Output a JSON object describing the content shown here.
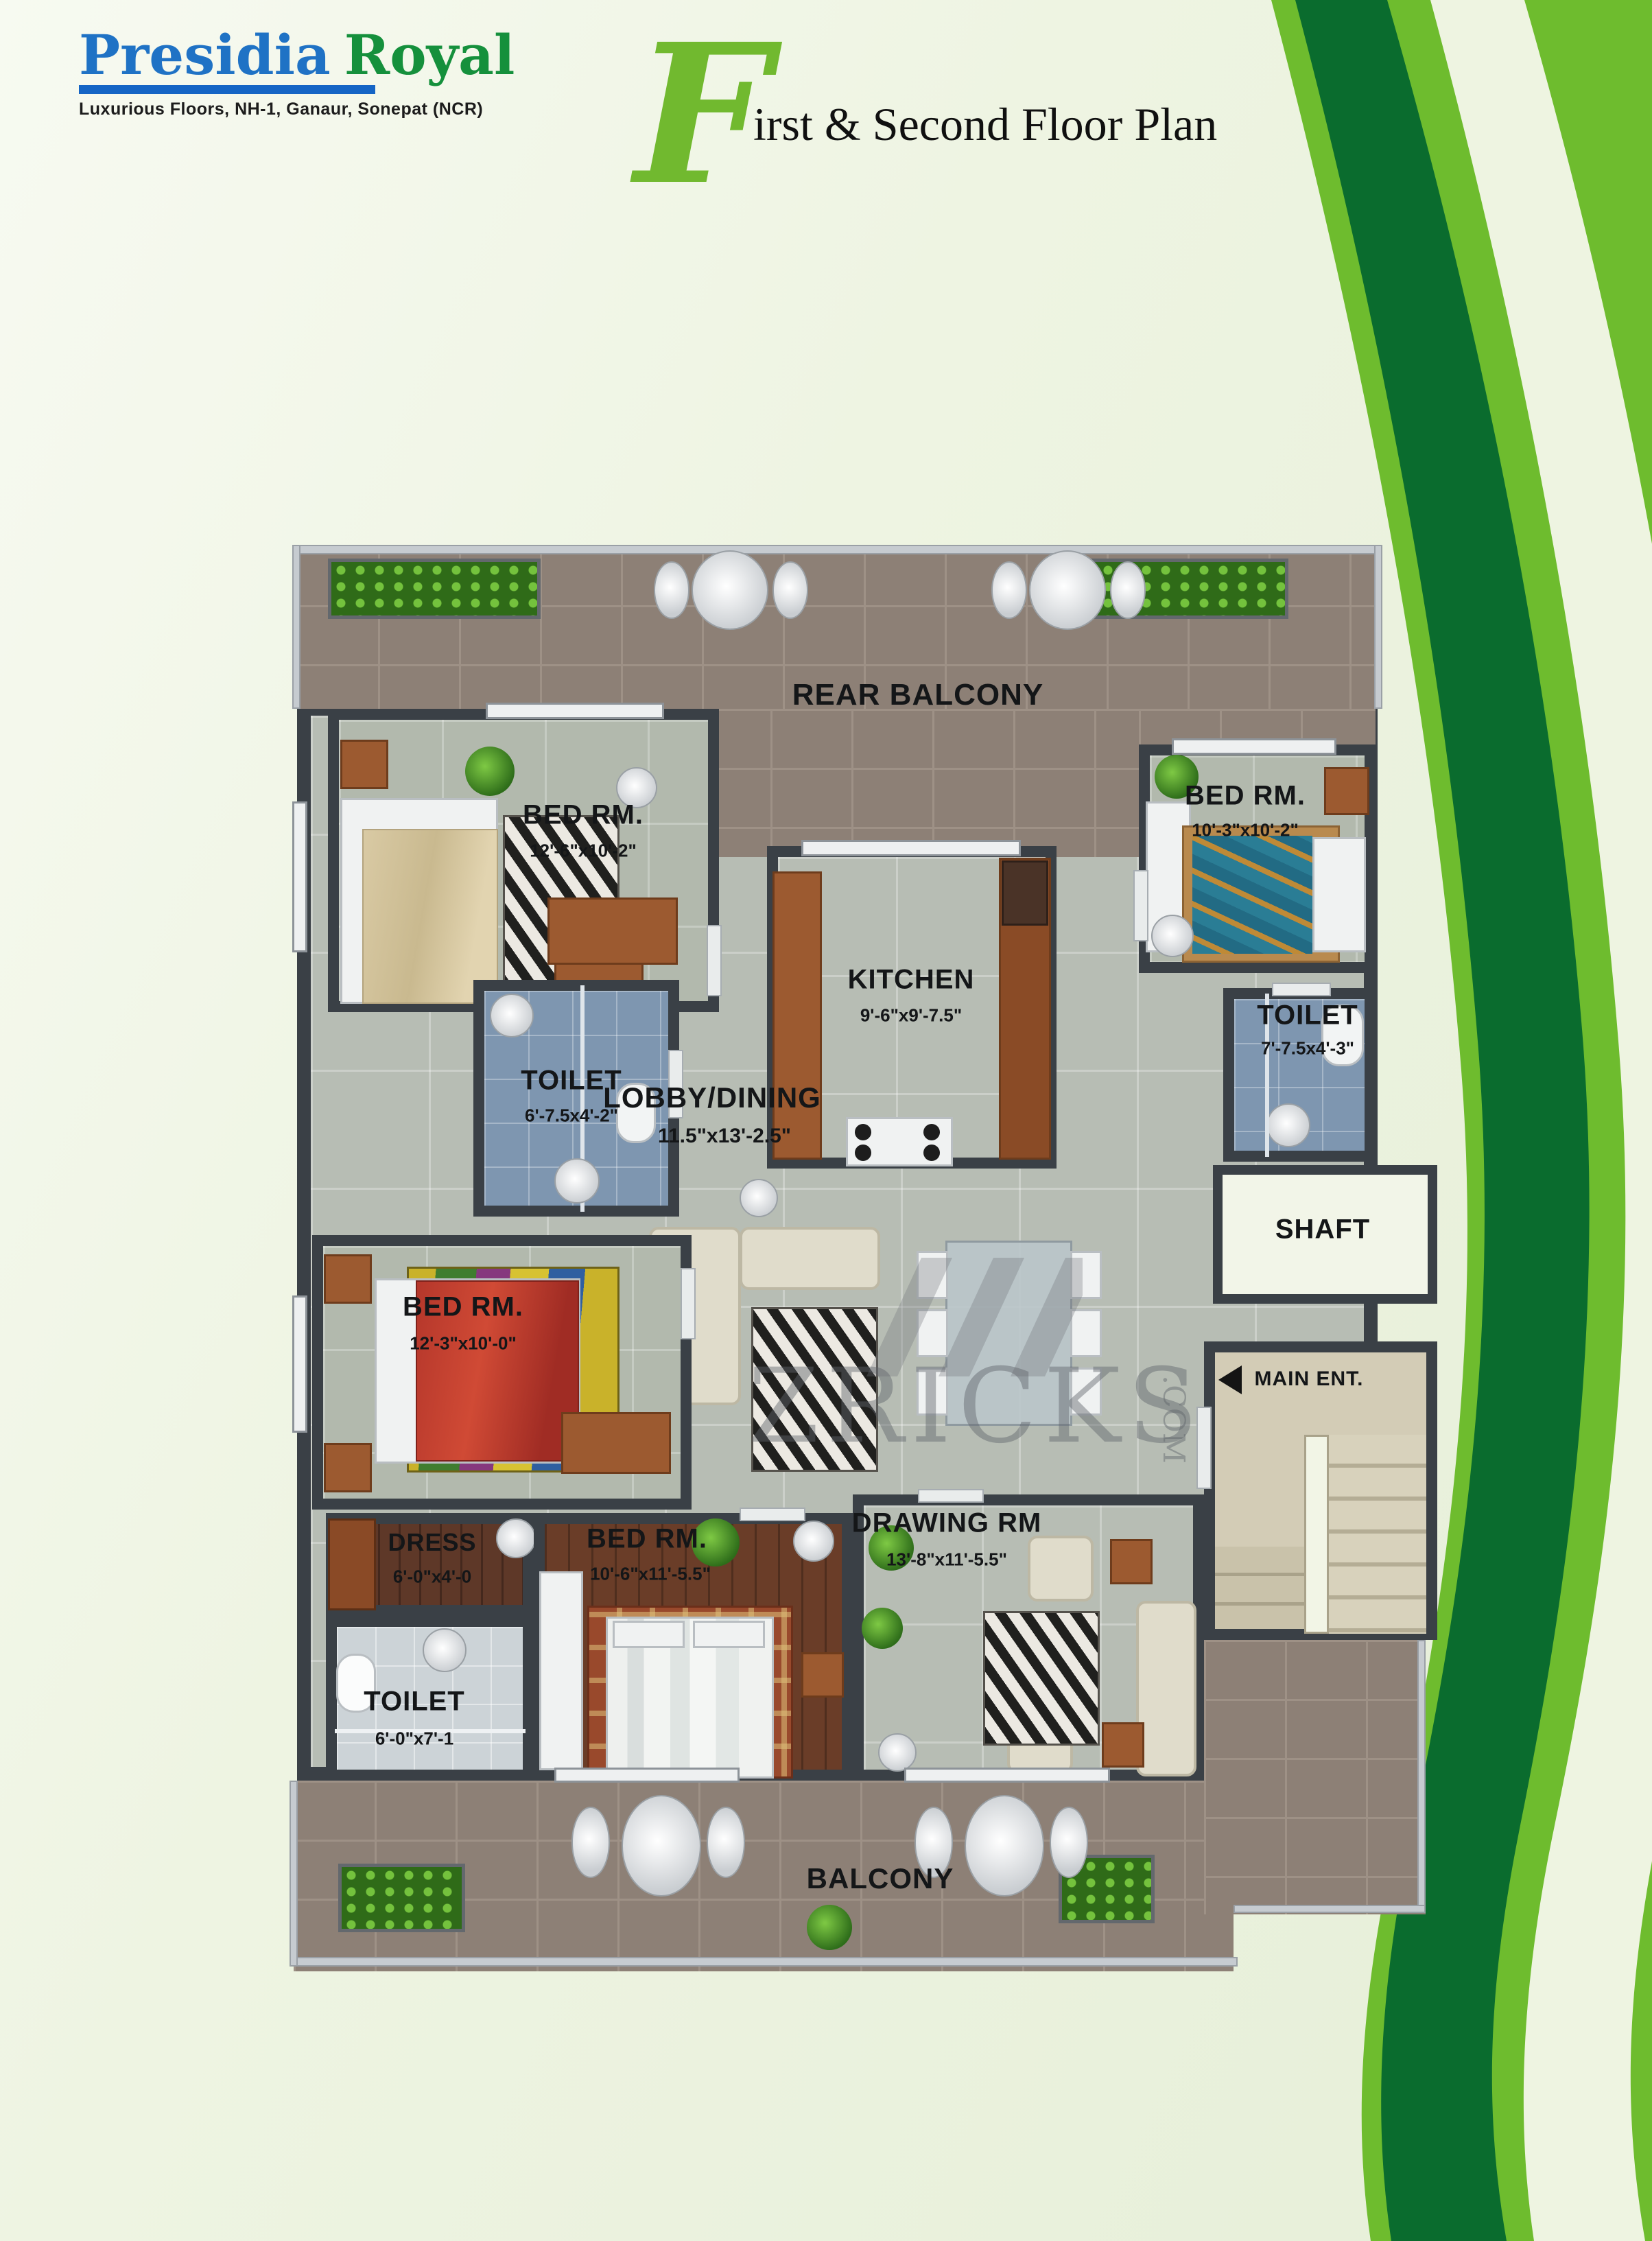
{
  "header": {
    "logo": {
      "name_primary": "Presidia",
      "name_secondary": "Royal",
      "subtitle": "Luxurious Floors, NH-1, Ganaur, Sonepat (NCR)"
    },
    "title": {
      "initial": "F",
      "rest": "irst & Second Floor Plan"
    }
  },
  "watermark": {
    "text": "ZRICKS",
    "suffix": ".COM"
  },
  "colors": {
    "accent_green": "#6ebc2e",
    "dark_green": "#0a6c2e",
    "pale_band": "#eef4e1",
    "logo_blue": "#1f72c5",
    "logo_green": "#15903c",
    "wall": "#3a4046"
  },
  "floor_plan": {
    "rooms": [
      {
        "id": "rear-balcony",
        "label": "REAR BALCONY",
        "dims": ""
      },
      {
        "id": "bed-room-1",
        "label": "BED RM.",
        "dims": "12'-6\"x10'-2\""
      },
      {
        "id": "kitchen",
        "label": "KITCHEN",
        "dims": "9'-6\"x9'-7.5\""
      },
      {
        "id": "bed-room-2",
        "label": "BED RM.",
        "dims": "10'-3\"x10'-2\""
      },
      {
        "id": "toilet-1",
        "label": "TOILET",
        "dims": "6'-7.5x4'-2\""
      },
      {
        "id": "toilet-2",
        "label": "TOILET",
        "dims": "7'-7.5x4'-3\""
      },
      {
        "id": "lobby-dining",
        "label": "LOBBY/DINING",
        "dims": "11.5\"x13'-2.5\""
      },
      {
        "id": "shaft",
        "label": "SHAFT",
        "dims": ""
      },
      {
        "id": "bed-room-3",
        "label": "BED RM.",
        "dims": "12'-3\"x10'-0\""
      },
      {
        "id": "dress",
        "label": "DRESS",
        "dims": "6'-0\"x4'-0"
      },
      {
        "id": "toilet-3",
        "label": "TOILET",
        "dims": "6'-0\"x7'-1"
      },
      {
        "id": "bed-room-4",
        "label": "BED RM.",
        "dims": "10'-6\"x11'-5.5\""
      },
      {
        "id": "drawing-room",
        "label": "DRAWING RM",
        "dims": "13'-8\"x11'-5.5\""
      },
      {
        "id": "main-entrance",
        "label": "MAIN ENT.",
        "dims": ""
      },
      {
        "id": "balcony",
        "label": "BALCONY",
        "dims": ""
      }
    ]
  }
}
